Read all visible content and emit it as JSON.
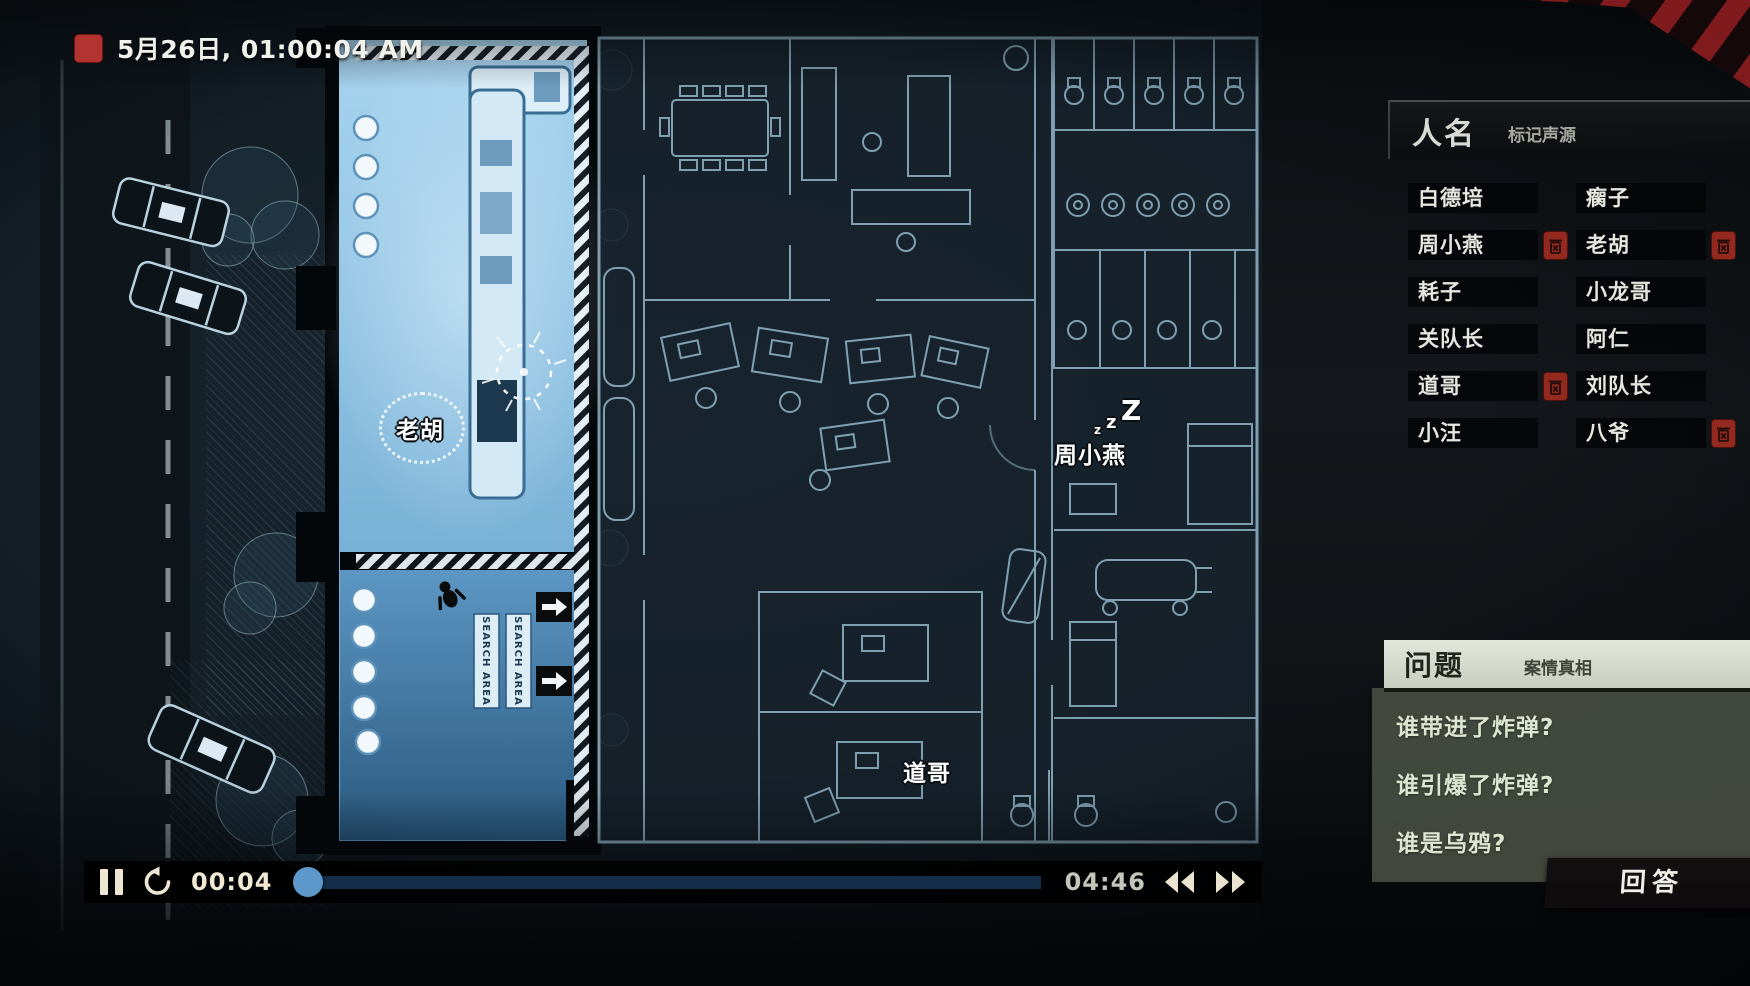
{
  "hud": {
    "datetime": "5月26日, 01:00:04 AM"
  },
  "names_panel": {
    "title": "人名",
    "subtitle": "标记声源",
    "names": [
      {
        "label": "白德培",
        "tagged": false
      },
      {
        "label": "瘸子",
        "tagged": false
      },
      {
        "label": "周小燕",
        "tagged": true
      },
      {
        "label": "老胡",
        "tagged": true
      },
      {
        "label": "耗子",
        "tagged": false
      },
      {
        "label": "小龙哥",
        "tagged": false
      },
      {
        "label": "关队长",
        "tagged": false
      },
      {
        "label": "阿仁",
        "tagged": false
      },
      {
        "label": "道哥",
        "tagged": true
      },
      {
        "label": "刘队长",
        "tagged": false
      },
      {
        "label": "小汪",
        "tagged": false
      },
      {
        "label": "八爷",
        "tagged": true
      }
    ]
  },
  "questions_panel": {
    "title": "问题",
    "subtitle": "案情真相",
    "questions": [
      "谁带进了炸弹?",
      "谁引爆了炸弹?",
      "谁是乌鸦?"
    ],
    "answer_button": "回答"
  },
  "playback": {
    "current_time": "00:04",
    "total_time": "04:46",
    "progress_percent": 1.5
  },
  "map": {
    "character_labels": [
      {
        "name": "老胡",
        "state": "speaking"
      },
      {
        "name": "周小燕",
        "state": "sleeping"
      },
      {
        "name": "道哥",
        "state": "idle"
      }
    ],
    "sleep_glyphs": [
      "z",
      "z",
      "Z"
    ],
    "search_area_label": "SEARCH AREA"
  },
  "colors": {
    "accent_red": "#93291f",
    "blueprint_line": "#9cc4d8",
    "highlight_room": "#8fc3e4",
    "panel_green": "#474d41",
    "cream": "#ece6d2"
  }
}
